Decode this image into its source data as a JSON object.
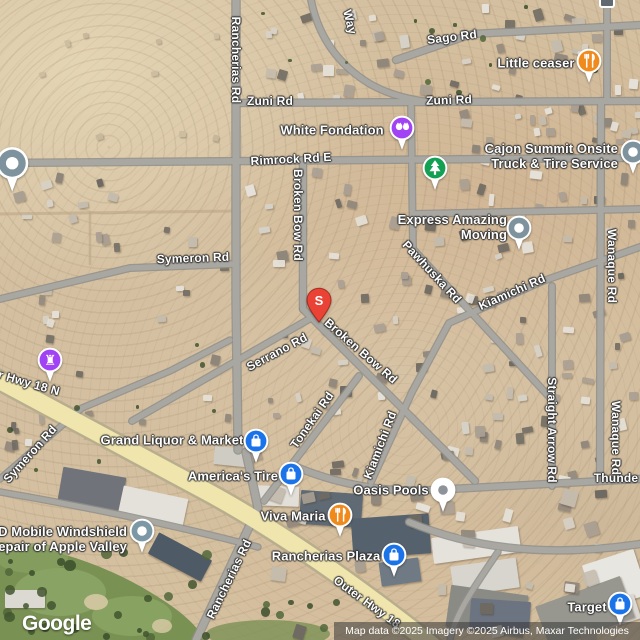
{
  "map": {
    "logo_text": "Google",
    "attribution": "Map data ©2025 Imagery ©2025 Airbus, Maxar Technologies",
    "marker": {
      "letter": "S",
      "x": 319,
      "y": 300
    },
    "colors": {
      "pin_blue": "#1A73E8",
      "pin_orange": "#F18A1D",
      "pin_green": "#14A053",
      "pin_purple": "#A142F4",
      "pin_gray": "#7E939E",
      "pin_gray2": "#7D98A5",
      "pin_white": "#FFFFFF",
      "pin_red": "#EA4335",
      "road_fill": "#a8a7a2",
      "road_casing": "#8f8e8a",
      "highway_fill": "#efe5ad",
      "highway_casing": "#b8ae8e",
      "label_text": "#FFFFFF",
      "golf_green": "#7a9154"
    },
    "road_labels": [
      {
        "text": "Sago Rd",
        "x": 452,
        "y": 37,
        "rot": -7
      },
      {
        "text": "Zuni Rd",
        "x": 270,
        "y": 101,
        "rot": 0
      },
      {
        "text": "Zuni Rd",
        "x": 449,
        "y": 100,
        "rot": -2
      },
      {
        "text": "Rancherias Rd",
        "x": 236,
        "y": 60,
        "rot": 90
      },
      {
        "text": "Rancherias Rd",
        "x": 229,
        "y": 579,
        "rot": -64
      },
      {
        "text": "Rimrock Rd E",
        "x": 291,
        "y": 159,
        "rot": -3
      },
      {
        "text": "Broken Bow Rd",
        "x": 298,
        "y": 215,
        "rot": 90
      },
      {
        "text": "Broken Bow Rd",
        "x": 361,
        "y": 351,
        "rot": 41
      },
      {
        "text": "Symeron Rd",
        "x": 193,
        "y": 258,
        "rot": -2
      },
      {
        "text": "Symeron Rd",
        "x": 30,
        "y": 454,
        "rot": -48
      },
      {
        "text": "Serrano Rd",
        "x": 277,
        "y": 352,
        "rot": -28
      },
      {
        "text": "Pawhuska Rd",
        "x": 432,
        "y": 272,
        "rot": 47
      },
      {
        "text": "Kiamichi Rd",
        "x": 512,
        "y": 292,
        "rot": -24
      },
      {
        "text": "Kiamichi Rd",
        "x": 380,
        "y": 445,
        "rot": -69
      },
      {
        "text": "Tonekai Rd",
        "x": 312,
        "y": 420,
        "rot": -55
      },
      {
        "text": "Wanaque Rd",
        "x": 612,
        "y": 266,
        "rot": 90
      },
      {
        "text": "Wanaque Rd",
        "x": 616,
        "y": 438,
        "rot": 90
      },
      {
        "text": "Straight Arrow Rd",
        "x": 552,
        "y": 430,
        "rot": 90
      },
      {
        "text": "Thunde",
        "x": 616,
        "y": 478,
        "rot": 0
      },
      {
        "text": "r Hwy 18 N",
        "x": 29,
        "y": 383,
        "rot": 16
      },
      {
        "text": "Outer Hwy 18",
        "x": 367,
        "y": 602,
        "rot": 36
      },
      {
        "text": "Way",
        "x": 350,
        "y": 22,
        "rot": 76
      }
    ],
    "poi_labels": [
      {
        "id": "little-ceaser",
        "lines": [
          "Little ceaser"
        ],
        "x": 536,
        "y": 63
      },
      {
        "id": "white-fondation",
        "lines": [
          "White Fondation"
        ],
        "x": 332,
        "y": 130
      },
      {
        "id": "cajon-summit",
        "lines": [
          "Cajon Summit Onsite",
          "Truck & Tire Service"
        ],
        "x": 618,
        "y": 156,
        "align": "right"
      },
      {
        "id": "express-moving",
        "lines": [
          "Express Amazing",
          "Moving"
        ],
        "x": 507,
        "y": 227,
        "align": "right"
      },
      {
        "id": "grand-liquor-market",
        "lines": [
          "Grand Liquor & Market"
        ],
        "x": 172,
        "y": 440
      },
      {
        "id": "americas-tire",
        "lines": [
          "America's Tire"
        ],
        "x": 233,
        "y": 476
      },
      {
        "id": "oasis-pools",
        "lines": [
          "Oasis Pools"
        ],
        "x": 391,
        "y": 490
      },
      {
        "id": "viva-maria",
        "lines": [
          "Viva Maria"
        ],
        "x": 293,
        "y": 516
      },
      {
        "id": "rancherias-plaza",
        "lines": [
          "Rancherias Plaza"
        ],
        "x": 326,
        "y": 556
      },
      {
        "id": "d-mobile-windshield",
        "lines": [
          "D Mobile Windshield",
          "epair of Apple Valley"
        ],
        "x": 127,
        "y": 539,
        "align": "right"
      },
      {
        "id": "target",
        "lines": [
          "Target"
        ],
        "x": 587,
        "y": 607
      }
    ],
    "pins": [
      {
        "id": "little-ceaser-pin",
        "icon": "restaurant-icon",
        "color": "pin_orange",
        "x": 589,
        "y": 61
      },
      {
        "id": "white-fondation-pin",
        "icon": "pets-icon",
        "color": "pin_purple",
        "x": 402,
        "y": 128
      },
      {
        "id": "park-pin",
        "icon": "tree-icon",
        "color": "pin_green",
        "x": 435,
        "y": 168
      },
      {
        "id": "cajon-summit-pin",
        "icon": "dot-icon",
        "color": "pin_gray",
        "x": 633,
        "y": 152
      },
      {
        "id": "express-moving-pin",
        "icon": "dot-icon",
        "color": "pin_gray",
        "x": 519,
        "y": 228
      },
      {
        "id": "west-edge-pin",
        "icon": "dot-icon",
        "color": "pin_gray",
        "x": 12,
        "y": 163,
        "scale": 1.3
      },
      {
        "id": "chess-club-pin",
        "icon": "chess-rook-icon",
        "color": "pin_purple",
        "x": 50,
        "y": 360
      },
      {
        "id": "grand-liquor-pin",
        "icon": "shopping-bag-icon",
        "color": "pin_blue",
        "x": 256,
        "y": 441
      },
      {
        "id": "americas-tire-pin",
        "icon": "shopping-bag-icon",
        "color": "pin_blue",
        "x": 291,
        "y": 474
      },
      {
        "id": "oasis-pools-pin",
        "icon": "dot-icon",
        "color": "pin_white",
        "glyph": "#8d9399",
        "x": 443,
        "y": 490
      },
      {
        "id": "viva-maria-pin",
        "icon": "restaurant-icon",
        "color": "pin_orange",
        "x": 340,
        "y": 515
      },
      {
        "id": "rancherias-plaza-pin",
        "icon": "shopping-bag-icon",
        "color": "pin_blue",
        "x": 394,
        "y": 555
      },
      {
        "id": "d-mobile-pin",
        "icon": "dot-icon",
        "color": "pin_gray2",
        "x": 142,
        "y": 531
      },
      {
        "id": "target-pin",
        "icon": "shopping-bag-icon",
        "color": "pin_blue",
        "x": 620,
        "y": 604
      }
    ]
  }
}
